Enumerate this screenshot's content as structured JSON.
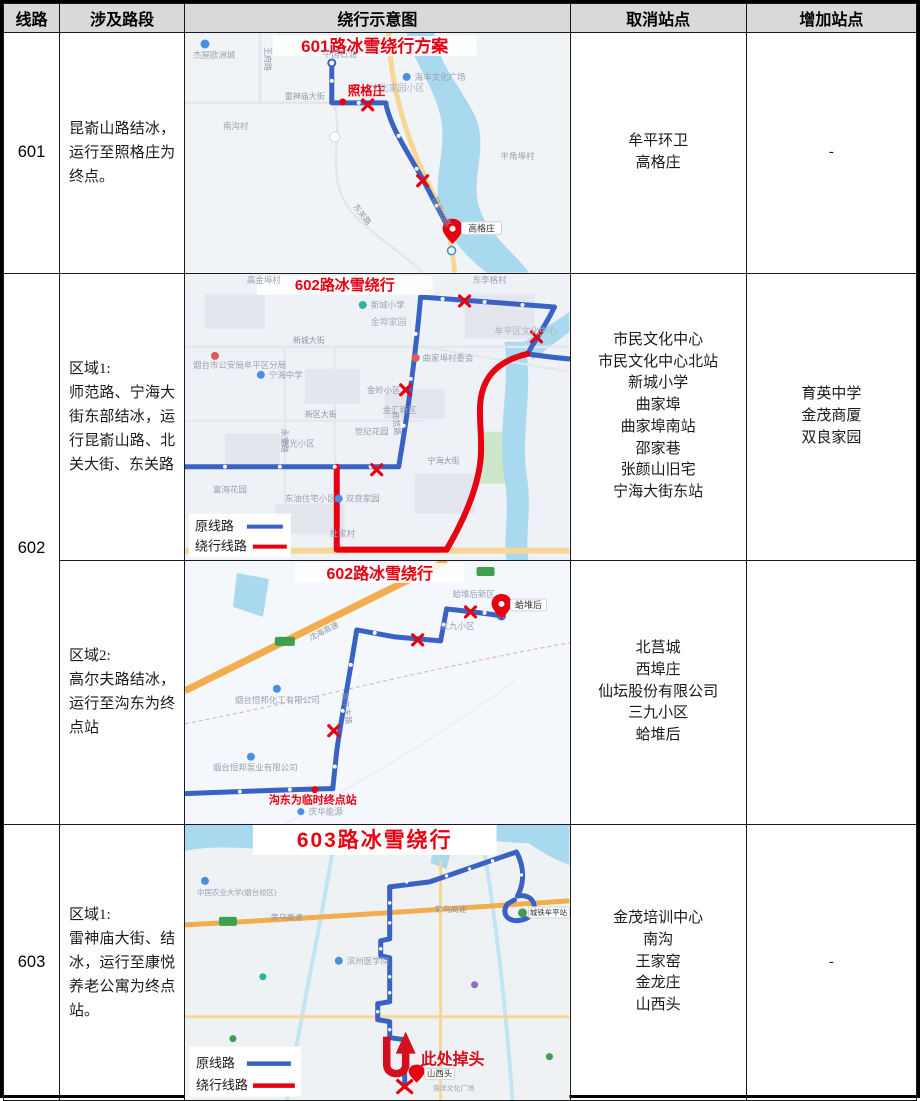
{
  "header": {
    "columns": [
      "线路",
      "涉及路段",
      "绕行示意图",
      "取消站点",
      "增加站点"
    ]
  },
  "colors": {
    "header_bg": "#d9d9d9",
    "border": "#000000",
    "route_blue": "#3a62c4",
    "detour_red": "#e60012",
    "title_red": "#e60012",
    "water_blue": "#a9d9ee",
    "highway_orange": "#f2ad4e",
    "map_bg": "#eff2f6"
  },
  "rows": [
    {
      "line": "601",
      "sections": [
        {
          "description": "昆嵛山路结冰，运行至照格庄为终点。",
          "cancelled": [
            "牟平环卫",
            "高格庄"
          ],
          "added": [
            "-"
          ],
          "map": {
            "title": "601路冰雪绕行方案",
            "station_red": "照格庄",
            "pin_label": "高格庄",
            "road_labels": [
              "雷神庙大街",
              "王府路",
              "东关路",
              "昆嵛山路"
            ],
            "poi_labels": [
              "杰屋欧洲城",
              "中国石油",
              "海丰文化广场",
              "文化家园小区",
              "南沟村",
              "半角埠村"
            ]
          }
        }
      ]
    },
    {
      "line": "602",
      "sections": [
        {
          "area_label": "区域1:",
          "description": "师范路、宁海大街东部结冰，运行昆嵛山路、北关大街、东关路",
          "cancelled": [
            "市民文化中心",
            "市民文化中心北站",
            "新城小学",
            "曲家埠",
            "曲家埠南站",
            "邵家巷",
            "张颜山旧宅",
            "宁海大街东站"
          ],
          "added": [
            "育英中学",
            "金茂商厦",
            "双良家园"
          ],
          "map": {
            "title": "602路冰雪绕行",
            "legend": {
              "original": "原线路",
              "detour": "绕行线路"
            },
            "road_labels": [
              "新城大街",
              "新区大街",
              "宁海大街",
              "永安路",
              "师范路"
            ],
            "poi_labels": [
              "高金埠村",
              "东李格村",
              "新城小学",
              "金埠家园",
              "牟平区文化中心",
              "曲家埠村委会",
              "金岭小区",
              "金汇新区",
              "世纪花园",
              "曙光小区",
              "东油住宅小区",
              "双良家园",
              "杜家村",
              "富海花园",
              "宁海中学",
              "烟台市公安局牟平区分局"
            ]
          }
        },
        {
          "area_label": "区域2:",
          "description": "高尔夫路结冰，运行至沟东为终点站",
          "cancelled": [
            "北莒城",
            "西埠庄",
            "仙坛股份有限公司",
            "三九小区",
            "蛤堆后"
          ],
          "added": [],
          "map": {
            "title": "602路冰雪绕行",
            "terminal_label": "沟东为临时终点站",
            "pin_label": "蛤堆后",
            "road_labels": [
              "沈海高速",
              "高尔夫路"
            ],
            "poi_labels": [
              "蛤堆后新区",
              "三九小区",
              "烟台恒邦化工有限公司",
              "烟台恒邦泵业有限公司",
              "庆华能源"
            ]
          }
        }
      ]
    },
    {
      "line": "603",
      "sections": [
        {
          "area_label": "区域1:",
          "description": "雷神庙大街、结冰，运行至康悦养老公寓为终点站。",
          "cancelled": [
            "金茂培训中心",
            "南沟",
            "王家窑",
            "金龙庄",
            "山西头"
          ],
          "added": [
            "-"
          ],
          "map": {
            "title": "603路冰雪绕行",
            "legend": {
              "original": "原线路",
              "detour": "绕行线路"
            },
            "uturn_label": "此处掉头",
            "pin_label": "山西头",
            "road_labels": [
              "荣乌高速",
              "荣乌高速"
            ],
            "poi_labels": [
              "中国农业大学(烟台校区)",
              "滨州医学院",
              "城铁牟平站",
              "海洋文化广场"
            ]
          }
        }
      ]
    }
  ]
}
